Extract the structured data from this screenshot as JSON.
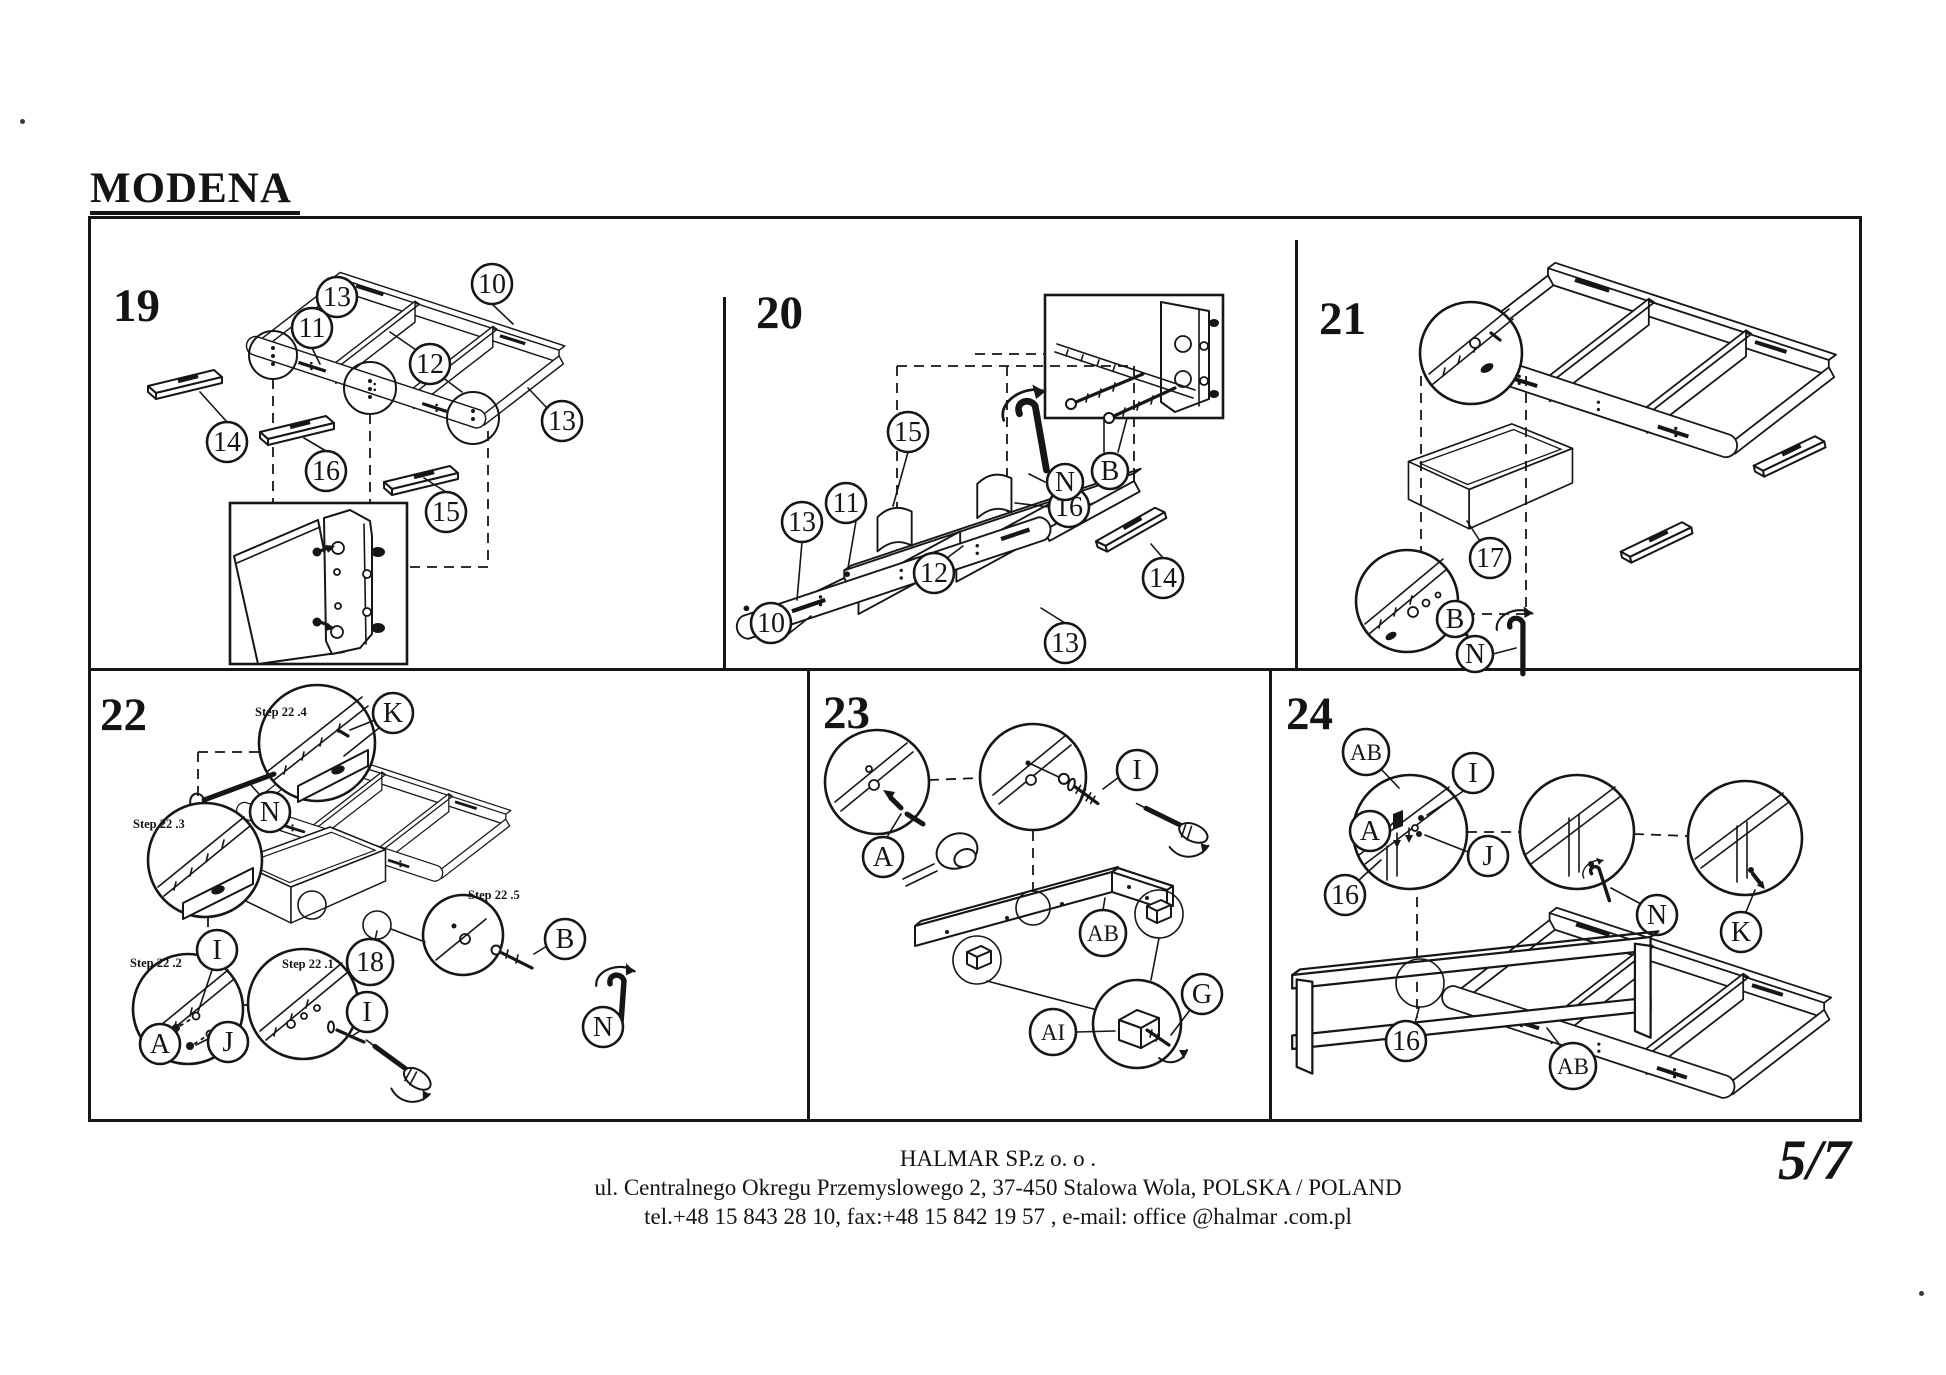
{
  "title": "MODENA",
  "page_number": "5/7",
  "footer": {
    "line1": "HALMAR SP.z o. o .",
    "line2": "ul. Centralnego Okregu Przemyslowego 2, 37-450 Stalowa Wola, POLSKA / POLAND",
    "line3": "tel.+48 15 843 28 10, fax:+48 15 842 19 57 , e-mail: office @halmar .com.pl"
  },
  "panels": {
    "p19": {
      "number": "19",
      "callouts": [
        "13",
        "10",
        "11",
        "12",
        "13",
        "14",
        "16",
        "15"
      ]
    },
    "p20": {
      "number": "20",
      "callouts": [
        "15",
        "16",
        "11",
        "13",
        "12",
        "10",
        "14",
        "13",
        "N",
        "B"
      ]
    },
    "p21": {
      "number": "21",
      "callouts": [
        "17",
        "B",
        "N"
      ]
    },
    "p22": {
      "number": "22",
      "steps": [
        "Step 22 .4",
        "Step 22 .3",
        "Step 22 .2",
        "Step 22 .1",
        "Step 22 .5"
      ],
      "callouts": [
        "K",
        "N",
        "I",
        "A",
        "J",
        "I",
        "18",
        "B",
        "N"
      ]
    },
    "p23": {
      "number": "23",
      "callouts": [
        "A",
        "I",
        "AB",
        "AI",
        "G"
      ]
    },
    "p24": {
      "number": "24",
      "callouts": [
        "AB",
        "I",
        "A",
        "J",
        "16",
        "N",
        "K",
        "16",
        "AB"
      ]
    }
  },
  "specks": {
    "top_left": ".",
    "bottom_right": "."
  }
}
